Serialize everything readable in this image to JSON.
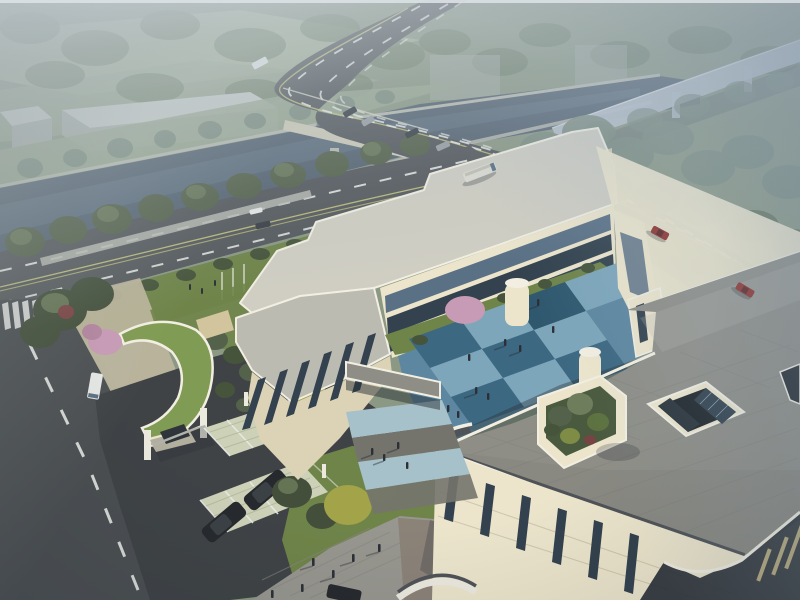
{
  "meta": {
    "title": "Aerial architectural rendering of a cream-colored campus building beside a canal, bridge and elevated highway",
    "type": "architectural-visualization",
    "view": "aerial bird's-eye perspective",
    "time_of_day": "hazy late afternoon"
  },
  "scene": {
    "environment": {
      "sky": "dense blue-grey haze over far landscape",
      "canal": "dark canal crossing diagonally with stone embankments",
      "bridge": "concrete road bridge carrying main road over canal",
      "viaduct": "curved elevated expressway fading into mist (top right)",
      "main_road": "multi-lane arterial with dashed white lanes and yellow center line",
      "west_street": "local street with crosswalk and dashed center line",
      "warehouses": "long grey shed and small grey boxes on far canal bank",
      "vegetation": "tree rows along canal and roads, dense misty tree belt"
    },
    "campus": {
      "main_building": {
        "floors": 3,
        "facade": "cream stone with dark glazed strips and rounded corners",
        "wings": [
          "rear wing",
          "west wing",
          "east wing",
          "front terrace block"
        ],
        "roof_terrace": "large grey paved roof deck with slate parapet band",
        "atrium": "square glazed light-well in roof deck",
        "roof_garden": "walled planter with trees on terrace",
        "corridor": "covered link bridge between wings",
        "stair_drums": "two white cylindrical stair towers"
      },
      "courtyard": {
        "paving": "blue checkerboard plaza tiles",
        "lawn": "grass strip with pink blossom tree along rear wing",
        "people": "small groups walking with long shadows"
      },
      "entrance": {
        "gatehouse": "curved pavilion with vivid green roof",
        "gate": "white pillars with barrier arm",
        "canopy": "small sand-colored canopy"
      },
      "parking": {
        "stalls": "grass-paver parking bays with white dividers",
        "fence": "white posts with pale mesh",
        "vehicles": "two black SUVs parked"
      },
      "plaza": "grey plank-paved forecourt with pedestrians",
      "paths": "light blue stepped walkway from courtyard to plaza"
    },
    "vehicles": [
      {
        "type": "bus",
        "color": "white",
        "location": "distant road"
      },
      {
        "type": "bus",
        "color": "cream",
        "location": "main road"
      },
      {
        "type": "car",
        "color": "dark",
        "location": "bridge"
      },
      {
        "type": "car",
        "color": "silver",
        "location": "bridge"
      },
      {
        "type": "car",
        "color": "red",
        "location": "main road east"
      },
      {
        "type": "car",
        "color": "red",
        "location": "main road far east"
      },
      {
        "type": "car",
        "color": "dark",
        "location": "boulevard"
      },
      {
        "type": "car",
        "color": "white",
        "location": "boulevard"
      },
      {
        "type": "van",
        "color": "white",
        "location": "west street"
      },
      {
        "type": "suv",
        "color": "black",
        "location": "parking"
      },
      {
        "type": "suv",
        "color": "black",
        "location": "parking"
      },
      {
        "type": "car",
        "color": "black",
        "location": "bottom street edge"
      }
    ],
    "people_count_estimate": 20
  },
  "colors": {
    "base": "#8b9884",
    "far_field": "#9aa892",
    "far_field_light": "#abb79c",
    "far_tree": "#74836b",
    "far_tree_dark": "#65755e",
    "mist_tree": "#7d8d80",
    "water": "#566472",
    "water_light": "#68798a",
    "embank": "#b7bab0",
    "warehouse_roof": "#c5cac6",
    "warehouse_wall": "#a9afa9",
    "viaduct": "#b7c1c9",
    "viaduct_shadow": "#4e5a66",
    "asphalt": "#55595c",
    "asphalt_dark": "#3f4346",
    "asphalt_street": "#4b4f52",
    "lane_white": "#e8eae6",
    "lane_yellow": "#c9c97e",
    "bridge_fascia": "#cecbb8",
    "tree_green": "#55624b",
    "tree_green_light": "#6e7d5c",
    "tree_dark": "#434f3b",
    "tree_yellow": "#a3a349",
    "tree_olive": "#7e8c46",
    "blossom_pink": "#c79ab5",
    "blossom_deep": "#b2849f",
    "shrub_red": "#7b4344",
    "lawn": "#6f8449",
    "lawn_dark": "#5d7240",
    "hedge": "#46543b",
    "green_roof": "#809b53",
    "wall_cream": "#ece5cc",
    "wall_cream_dark": "#dcd3b6",
    "wall_shadowed": "#c9bfa2",
    "roof_light": "#d0cec3",
    "roof_gray": "#bcbbb2",
    "terrace_gray": "#8e8e87",
    "terrace_dark": "#74746d",
    "parapet_slate": "#4f5357",
    "trim_white": "#f2efe2",
    "glass_dark": "#33424e",
    "glass_mid": "#5a7084",
    "glass_light": "#9db3c2",
    "court_blue_light": "#7da6ba",
    "court_blue": "#5d87a0",
    "court_blue_dark": "#3d6882",
    "court_blue_deep": "#2f586f",
    "path_blue": "#a7c1cb",
    "plaza_gray": "#97968f",
    "plaza_warm": "#8b8278",
    "paver_tan": "#beb69e",
    "gravel_stall": "#cdd1b8",
    "suv_black": "#26292d",
    "car_red": "#8f322d",
    "car_dark": "#3a3f45",
    "car_silver": "#9aa0a4",
    "van_white": "#e6e8e5",
    "bus_cream": "#dcdcd2",
    "figure_dark": "#2c3036",
    "shadow": "#2a3138",
    "white_post": "#eceadf",
    "fence_mesh": "#cdd6bd",
    "sand_canopy": "#d2c49c",
    "facade_dark": "#2f353b"
  }
}
